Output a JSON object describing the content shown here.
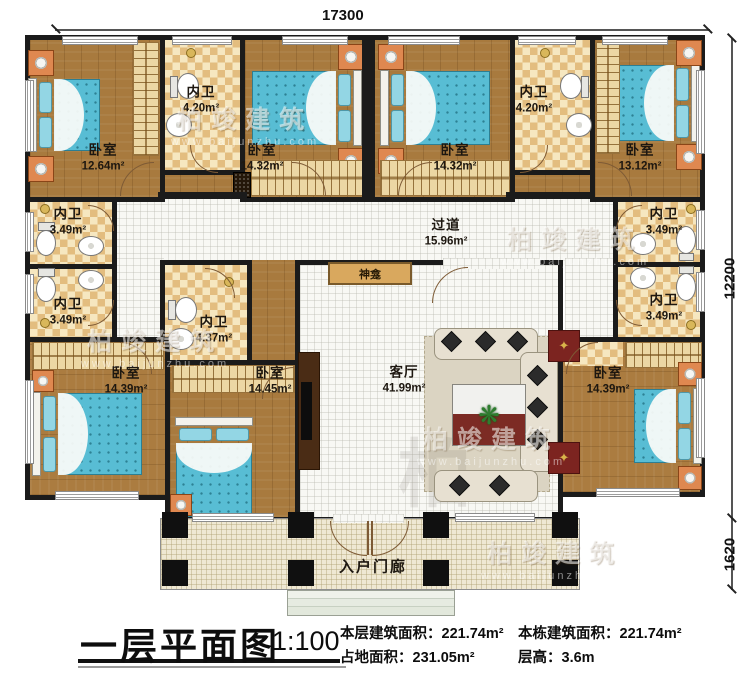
{
  "dimensions": {
    "top": "17300",
    "side": "12200",
    "porch": "1620"
  },
  "watermark": {
    "brand": "柏竣建筑",
    "url": "www.baijunzhu.com"
  },
  "rooms": [
    {
      "name": "卧室",
      "area": "12.64m²"
    },
    {
      "name": "内卫",
      "area": "4.20m²"
    },
    {
      "name": "卧室",
      "area": "14.32m²"
    },
    {
      "name": "卧室",
      "area": "14.32m²"
    },
    {
      "name": "内卫",
      "area": "4.20m²"
    },
    {
      "name": "卧室",
      "area": "13.12m²"
    },
    {
      "name": "内卫",
      "area": "3.49m²"
    },
    {
      "name": "内卫",
      "area": "3.49m²"
    },
    {
      "name": "内卫",
      "area": "3.49m²"
    },
    {
      "name": "内卫",
      "area": "3.49m²"
    },
    {
      "name": "内卫",
      "area": "4.37m²"
    },
    {
      "name": "过道",
      "area": "15.96m²"
    },
    {
      "name": "客厅",
      "area": "41.99m²"
    },
    {
      "name": "卧室",
      "area": "14.39m²"
    },
    {
      "name": "卧室",
      "area": "14.45m²"
    },
    {
      "name": "卧室",
      "area": "14.39m²"
    },
    {
      "name": "神龛"
    },
    {
      "name": "入户门廊"
    }
  ],
  "footer": {
    "title": "一层平面图",
    "scale": "1:100",
    "stats": [
      {
        "label": "本层建筑面积：",
        "value": "221.74m²"
      },
      {
        "label": "本栋建筑面积：",
        "value": "221.74m²"
      },
      {
        "label": "占地面积：",
        "value": "231.05m²"
      },
      {
        "label": "层高：",
        "value": "3.6m"
      }
    ]
  }
}
